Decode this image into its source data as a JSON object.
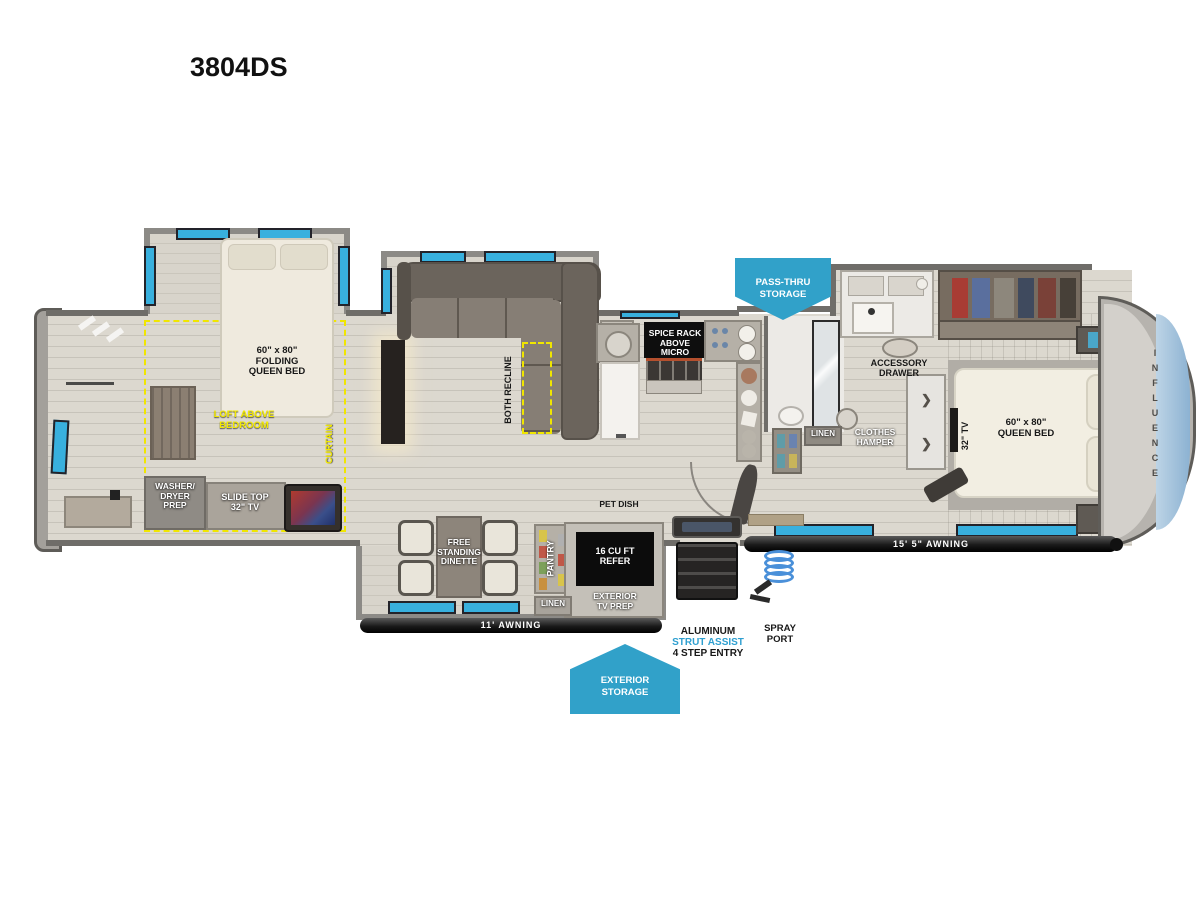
{
  "title": "3804DS",
  "brand_name": "INFLUENCE",
  "colors": {
    "banner_blue": "#31a1c9",
    "window_blue": "#38b0de",
    "highlight_yellow": "#f2e900",
    "strut_blue": "#2e9fd0"
  },
  "icons": {
    "closet_chevron": "❯"
  },
  "banners": {
    "pass_thru": "PASS-THRU\nSTORAGE",
    "exterior_storage": "EXTERIOR\nSTORAGE"
  },
  "awnings": {
    "small": "11' AWNING",
    "main": "15' 5\" AWNING"
  },
  "rooms": {
    "loft_bedroom": {
      "bed": "60\" x 80\"\nFOLDING\nQUEEN BED",
      "loft": "LOFT ABOVE\nBEDROOM",
      "curtain": "CURTAIN",
      "washer": "WASHER/\nDRYER\nPREP",
      "tv": "SLIDE TOP\n32\" TV"
    },
    "living": {
      "ent_center": "ENT. CENTER\nw/ 50\" TV",
      "recline": "BOTH RECLINE"
    },
    "kitchen": {
      "spice_rack": "SPICE RACK\nABOVE MICRO",
      "pet_dish": "PET DISH",
      "dinette": "FREE\nSTANDING\nDINETTE",
      "pantry": "PANTRY",
      "refer": "16 CU FT\nREFER",
      "linen": "LINEN",
      "ext_tv": "EXTERIOR\nTV PREP"
    },
    "bath": {
      "linen": "LINEN",
      "hamper": "CLOTHES\nHAMPER",
      "accessory": "ACCESSORY\nDRAWER"
    },
    "bedroom": {
      "bed": "60\" x 80\"\nQUEEN BED",
      "tv": "32\" TV"
    }
  },
  "exterior": {
    "entry_line1": "ALUMINUM",
    "entry_line2": "STRUT ASSIST",
    "entry_line3": "4 STEP ENTRY",
    "spray_port": "SPRAY\nPORT"
  }
}
